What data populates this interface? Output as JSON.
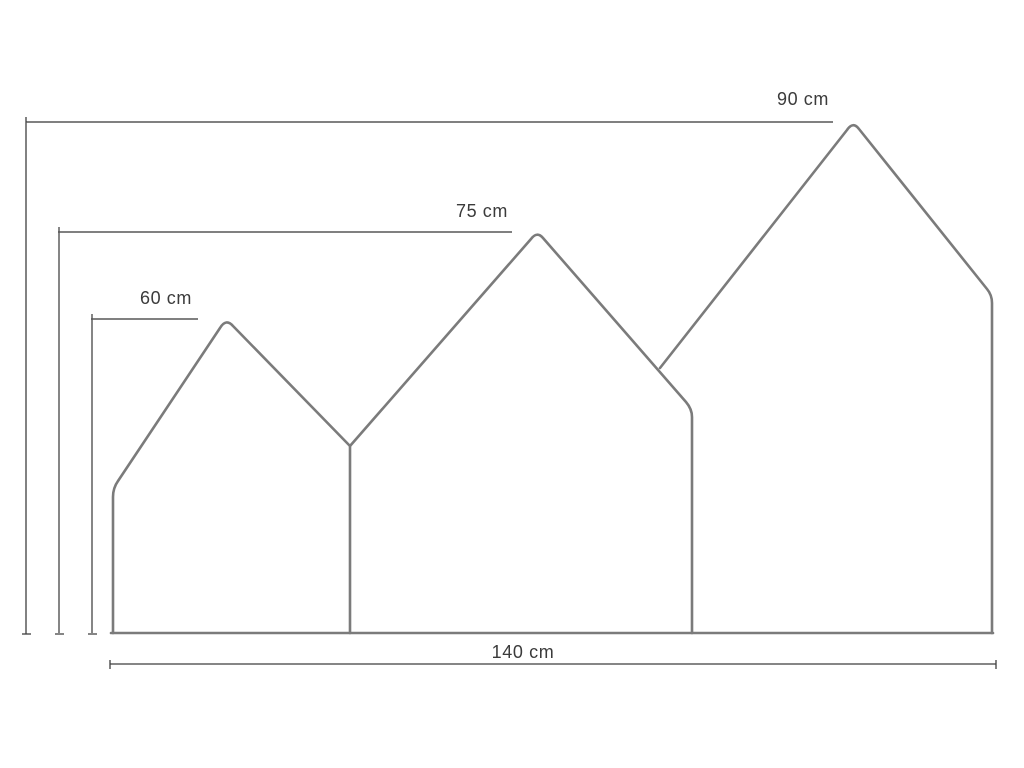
{
  "diagram": {
    "type": "technical-dimension-drawing",
    "subject": "three-peak house-shaped panel",
    "dimensions": {
      "left_height": {
        "label": "60 cm",
        "value": 60,
        "unit": "cm"
      },
      "middle_height": {
        "label": "75 cm",
        "value": 75,
        "unit": "cm"
      },
      "right_height": {
        "label": "90 cm",
        "value": 90,
        "unit": "cm"
      },
      "total_width": {
        "label": "140 cm",
        "value": 140,
        "unit": "cm"
      }
    },
    "colors": {
      "background": "#ffffff",
      "outline": "#7b7b7b",
      "dimension_line": "#3f3f3f",
      "extension_line": "#868686",
      "label_text": "#3b3b3b"
    }
  }
}
